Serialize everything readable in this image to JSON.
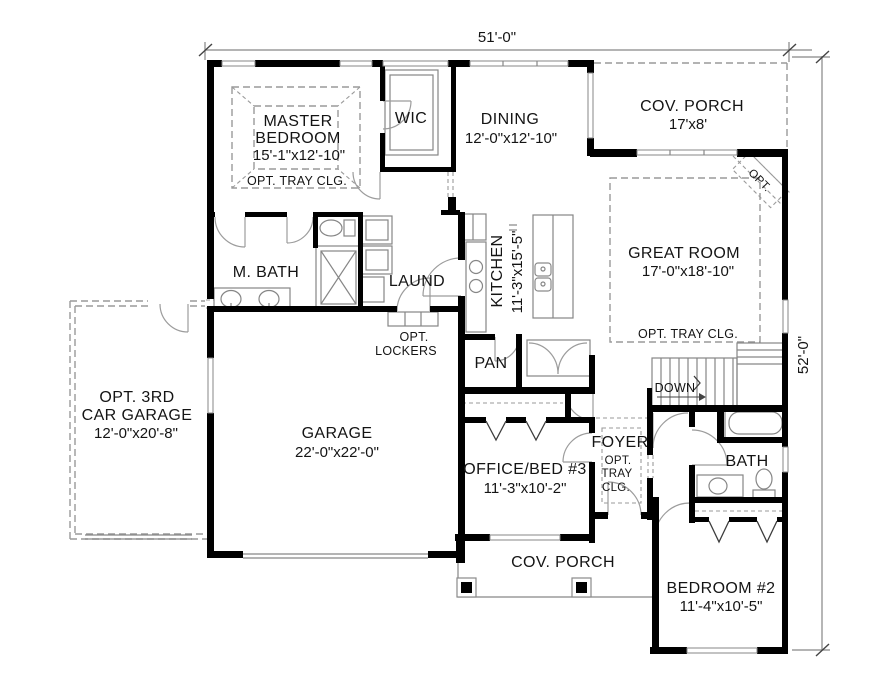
{
  "labels": {
    "dim_width": "51'-0\"",
    "dim_height": "52'-0\"",
    "master_1": "MASTER",
    "master_2": "BEDROOM",
    "master_size": "15'-1\"x12'-10\"",
    "master_note": "OPT. TRAY CLG.",
    "wic": "WIC",
    "dining": "DINING",
    "dining_size": "12'-0\"x12'-10\"",
    "cov_porch_top": "COV. PORCH",
    "cov_porch_top_size": "17'x8'",
    "opt_fireplace": "OPT.",
    "great_room": "GREAT ROOM",
    "great_room_size": "17'-0\"x18'-10\"",
    "great_room_note": "OPT. TRAY CLG.",
    "m_bath": "M. BATH",
    "laundry": "LAUND",
    "kitchen": "KITCHEN",
    "kitchen_size": "11'-3\"x15'-5\"",
    "lockers_1": "OPT.",
    "lockers_2": "LOCKERS",
    "pantry": "PAN",
    "stairs": "DOWN",
    "opt_garage_1": "OPT. 3RD",
    "opt_garage_2": "CAR GARAGE",
    "opt_garage_size": "12'-0\"x20'-8\"",
    "garage": "GARAGE",
    "garage_size": "22'-0\"x22'-0\"",
    "office": "OFFICE/BED #3",
    "office_size": "11'-3\"x10'-2\"",
    "foyer": "FOYER",
    "foyer_note_1": "OPT.",
    "foyer_note_2": "TRAY",
    "foyer_note_3": "CLG.",
    "bath": "BATH",
    "bedroom2": "BEDROOM #2",
    "bedroom2_size": "11'-4\"x10'-5\"",
    "cov_porch_bottom": "COV. PORCH"
  },
  "colors": {
    "wall": "#000000",
    "thin_line": "#868686",
    "dashed_line": "#9a9a9a",
    "text": "#141414",
    "background": "#ffffff"
  }
}
